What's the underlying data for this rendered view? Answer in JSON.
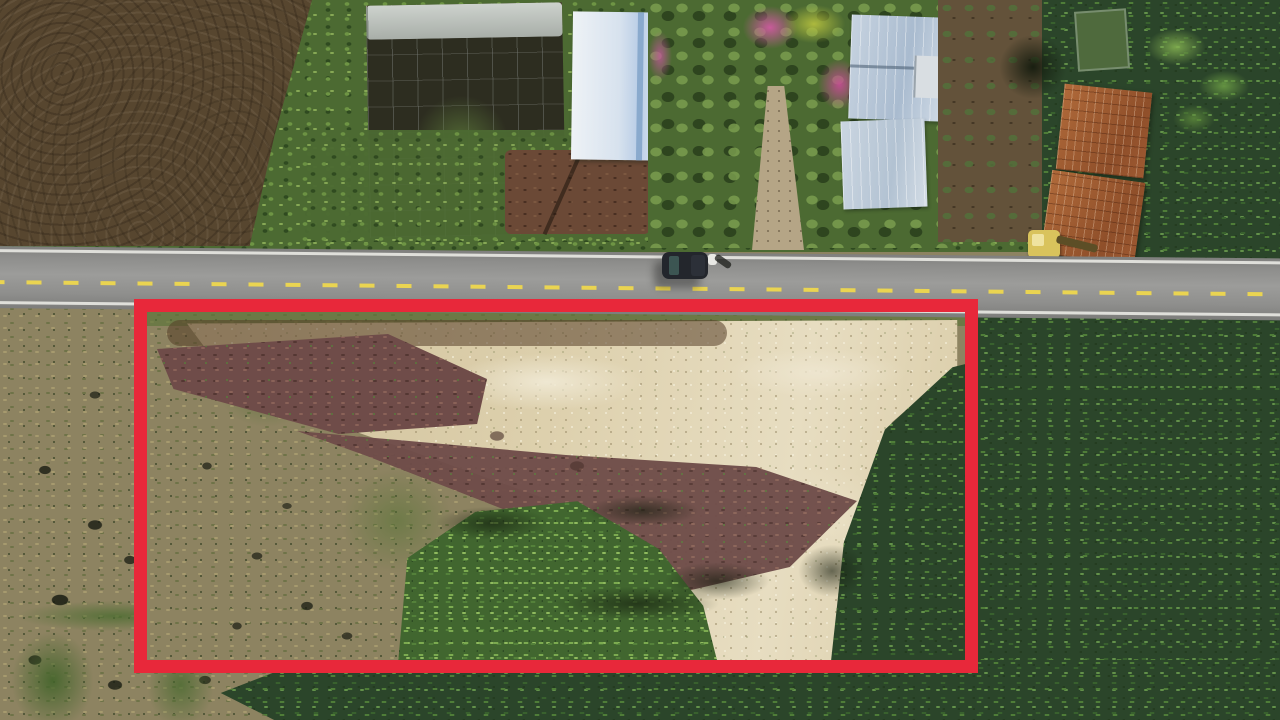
{
  "meta": {
    "image_type": "aerial-drone-photograph",
    "subject": "Roadside land plot for sale highlighted with a red rectangle, surrounded by farmland and banana plantations",
    "resolution": "1280x720",
    "visible_text": "none"
  },
  "annotation": {
    "label": "land-plot-highlight-rectangle",
    "shape": "rectangle",
    "color": "#e8283a",
    "x": 134,
    "y": 299,
    "width": 844,
    "height": 374,
    "border_px": 13
  },
  "road": {
    "label": "asphalt-road",
    "surface_color": "#8f8f8d",
    "centerline": {
      "style": "dashed",
      "color": "#ead451"
    },
    "edge_lines": {
      "style": "solid",
      "color": "#e9e9e3"
    },
    "vehicles": [
      {
        "label": "dark-pickup-truck",
        "body_color": "#23262c"
      },
      {
        "label": "motorbike-with-rider",
        "body_color": "#e8e8e4"
      }
    ]
  },
  "regions": [
    {
      "label": "tilled-brown-field",
      "color": "#57462f"
    },
    {
      "label": "net-greenhouse-trellis",
      "color": "#4a4430"
    },
    {
      "label": "vegetable-garden-rows",
      "color": "#4c6a32"
    },
    {
      "label": "white-blue-metal-roof-building",
      "color": "#d7e2ee"
    },
    {
      "label": "bougainvillea-trees",
      "color": "#cf5aa0"
    },
    {
      "label": "farmhouse-blue-gray-roof",
      "color": "#b9cbdf"
    },
    {
      "label": "dirt-path-to-road",
      "color": "#b5a586"
    },
    {
      "label": "orchard-rows",
      "color": "#63523a"
    },
    {
      "label": "rusty-corrugated-roof-barn",
      "color": "#a55c33"
    },
    {
      "label": "yellow-excavator",
      "color": "#d9c35c"
    },
    {
      "label": "banana-plantation",
      "color": "#2b452a"
    },
    {
      "label": "scrub-grass-field",
      "color": "#8d8361"
    },
    {
      "label": "cleared-sandy-soil",
      "color": "#d8caa5"
    },
    {
      "label": "turned-maroon-soil",
      "color": "#6f4c49"
    },
    {
      "label": "young-banana-patch",
      "color": "#41662f"
    }
  ]
}
